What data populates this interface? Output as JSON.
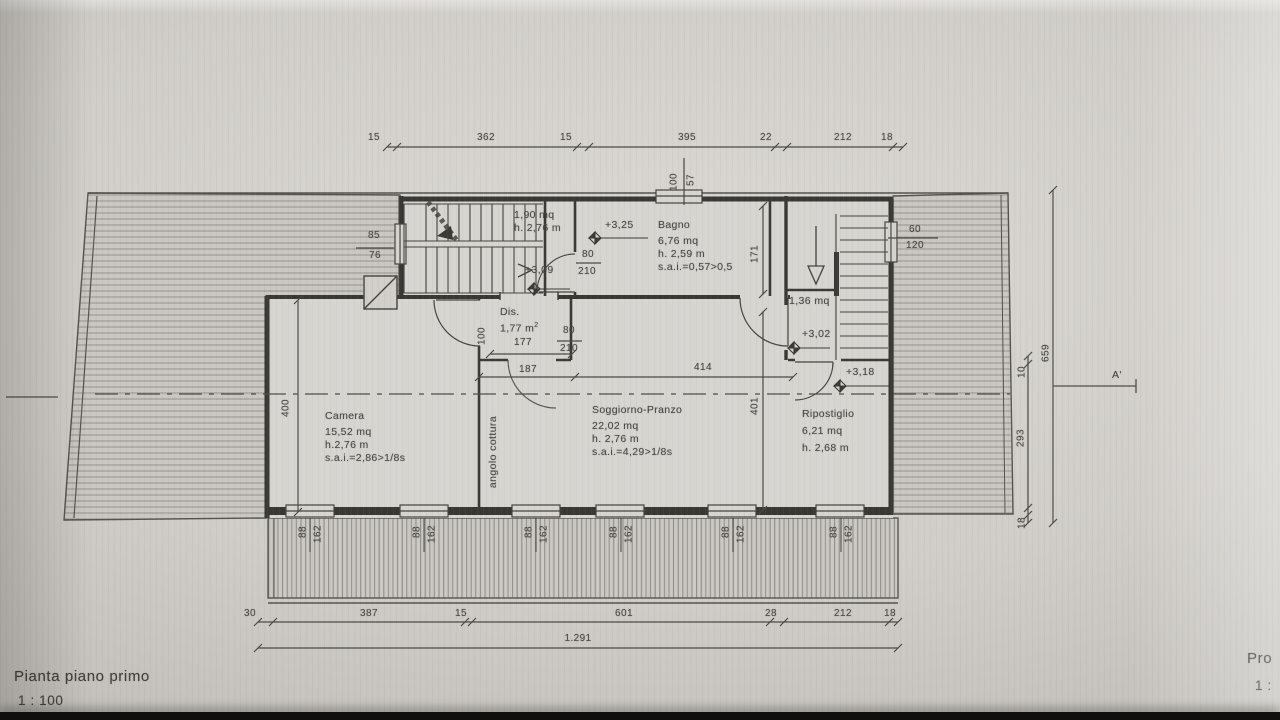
{
  "photo": {
    "title": "Pianta piano primo",
    "scale": "1 : 100",
    "corner_title": "Pro",
    "corner_scale": "1 :",
    "section_label": "A'"
  },
  "rooms": {
    "camera": {
      "name": "Camera",
      "area": "15,52 mq",
      "height": "h.2,76 m",
      "sai": "s.a.i.=2,86>1/8s"
    },
    "soggiorno": {
      "name": "Soggiorno-Pranzo",
      "area": "22,02 mq",
      "height": "h. 2,76 m",
      "sai": "s.a.i.=4,29>1/8s"
    },
    "bagno": {
      "name": "Bagno",
      "area": "6,76 mq",
      "height": "h. 2,59 m",
      "sai": "s.a.i.=0,57>0,5"
    },
    "ripostiglio": {
      "name": "Ripostiglio",
      "area": "6,21 mq",
      "height": "h. 2,68 m"
    },
    "disimpegno": {
      "name": "Dis.",
      "area": "1,77 m",
      "area_exp": "2"
    },
    "stairwell": {
      "area": "1,90 mq",
      "height": "h. 2,76 m"
    },
    "stair_closet": {
      "area": "1,36 mq"
    },
    "kitchen_corner": "angolo cottura"
  },
  "levels": {
    "bagno": "+3,25",
    "landing": "+3,09",
    "stair_closet": "+3,02",
    "ripostiglio": "+3,18"
  },
  "dims": {
    "top": [
      "15",
      "362",
      "15",
      "395",
      "22",
      "212",
      "18"
    ],
    "bottom": [
      "30",
      "387",
      "15",
      "601",
      "28",
      "212",
      "18"
    ],
    "bottom_total": "1.291",
    "right_total": "659",
    "right_inner": [
      "10",
      "293",
      "18"
    ],
    "camera_depth": "400",
    "soggiorno_depth": "401",
    "soggiorno_width": "414",
    "dis_outer_width": "187",
    "dis_inner_width": "177",
    "dis_depth": "100",
    "bagno_depth": "171",
    "door_stair": {
      "w": "80",
      "h": "210"
    },
    "door_dis": {
      "w": "80",
      "h": "210"
    },
    "window_bagno": {
      "w": "100",
      "h": "57"
    },
    "window_stair": {
      "w": "85",
      "h": "76"
    },
    "window_right": {
      "w": "60",
      "h": "120"
    },
    "bottom_windows": [
      {
        "w": "88",
        "h": "162"
      },
      {
        "w": "88",
        "h": "162"
      },
      {
        "w": "88",
        "h": "162"
      },
      {
        "w": "88",
        "h": "162"
      },
      {
        "w": "88",
        "h": "162"
      },
      {
        "w": "88",
        "h": "162"
      }
    ]
  }
}
